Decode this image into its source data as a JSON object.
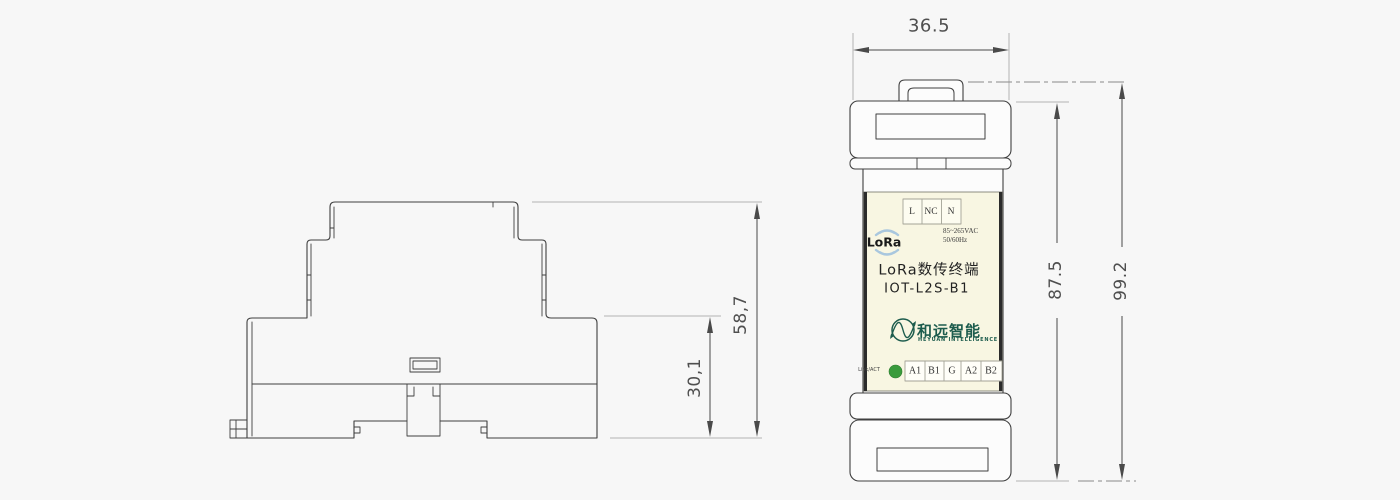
{
  "drawing": {
    "type": "engineering-dimension-drawing",
    "views": [
      "side-profile",
      "front"
    ]
  },
  "side_view": {
    "dim_total_height": "58,7",
    "dim_lower_height": "30,1"
  },
  "front_view": {
    "dim_width": "36.5",
    "dim_body_height": "87.5",
    "dim_total_height": "99.2",
    "device": {
      "top_terminals": [
        "L",
        "NC",
        "N"
      ],
      "power_rating_line1": "85~265VAC",
      "power_rating_line2": "50/60Hz",
      "radio_label": "LoRa",
      "product_title": "LoRa数传终端",
      "model": "IOT-L2S-B1",
      "brand_cn": "和远智能",
      "brand_en": "HEYUAN INTELLIGENCE",
      "led_label": "Link/ACT",
      "bottom_terminals": [
        "A1",
        "B1",
        "G",
        "A2",
        "B2"
      ]
    }
  },
  "colors": {
    "background": "#f7f7f7",
    "line": "#3f3f3f",
    "extension_line": "#b3b3b3",
    "label_cream": "#f8f6e2",
    "brand_green": "#1d5c4d",
    "led_green": "#3a9b3c",
    "lora_blue": "#a9c7de"
  }
}
